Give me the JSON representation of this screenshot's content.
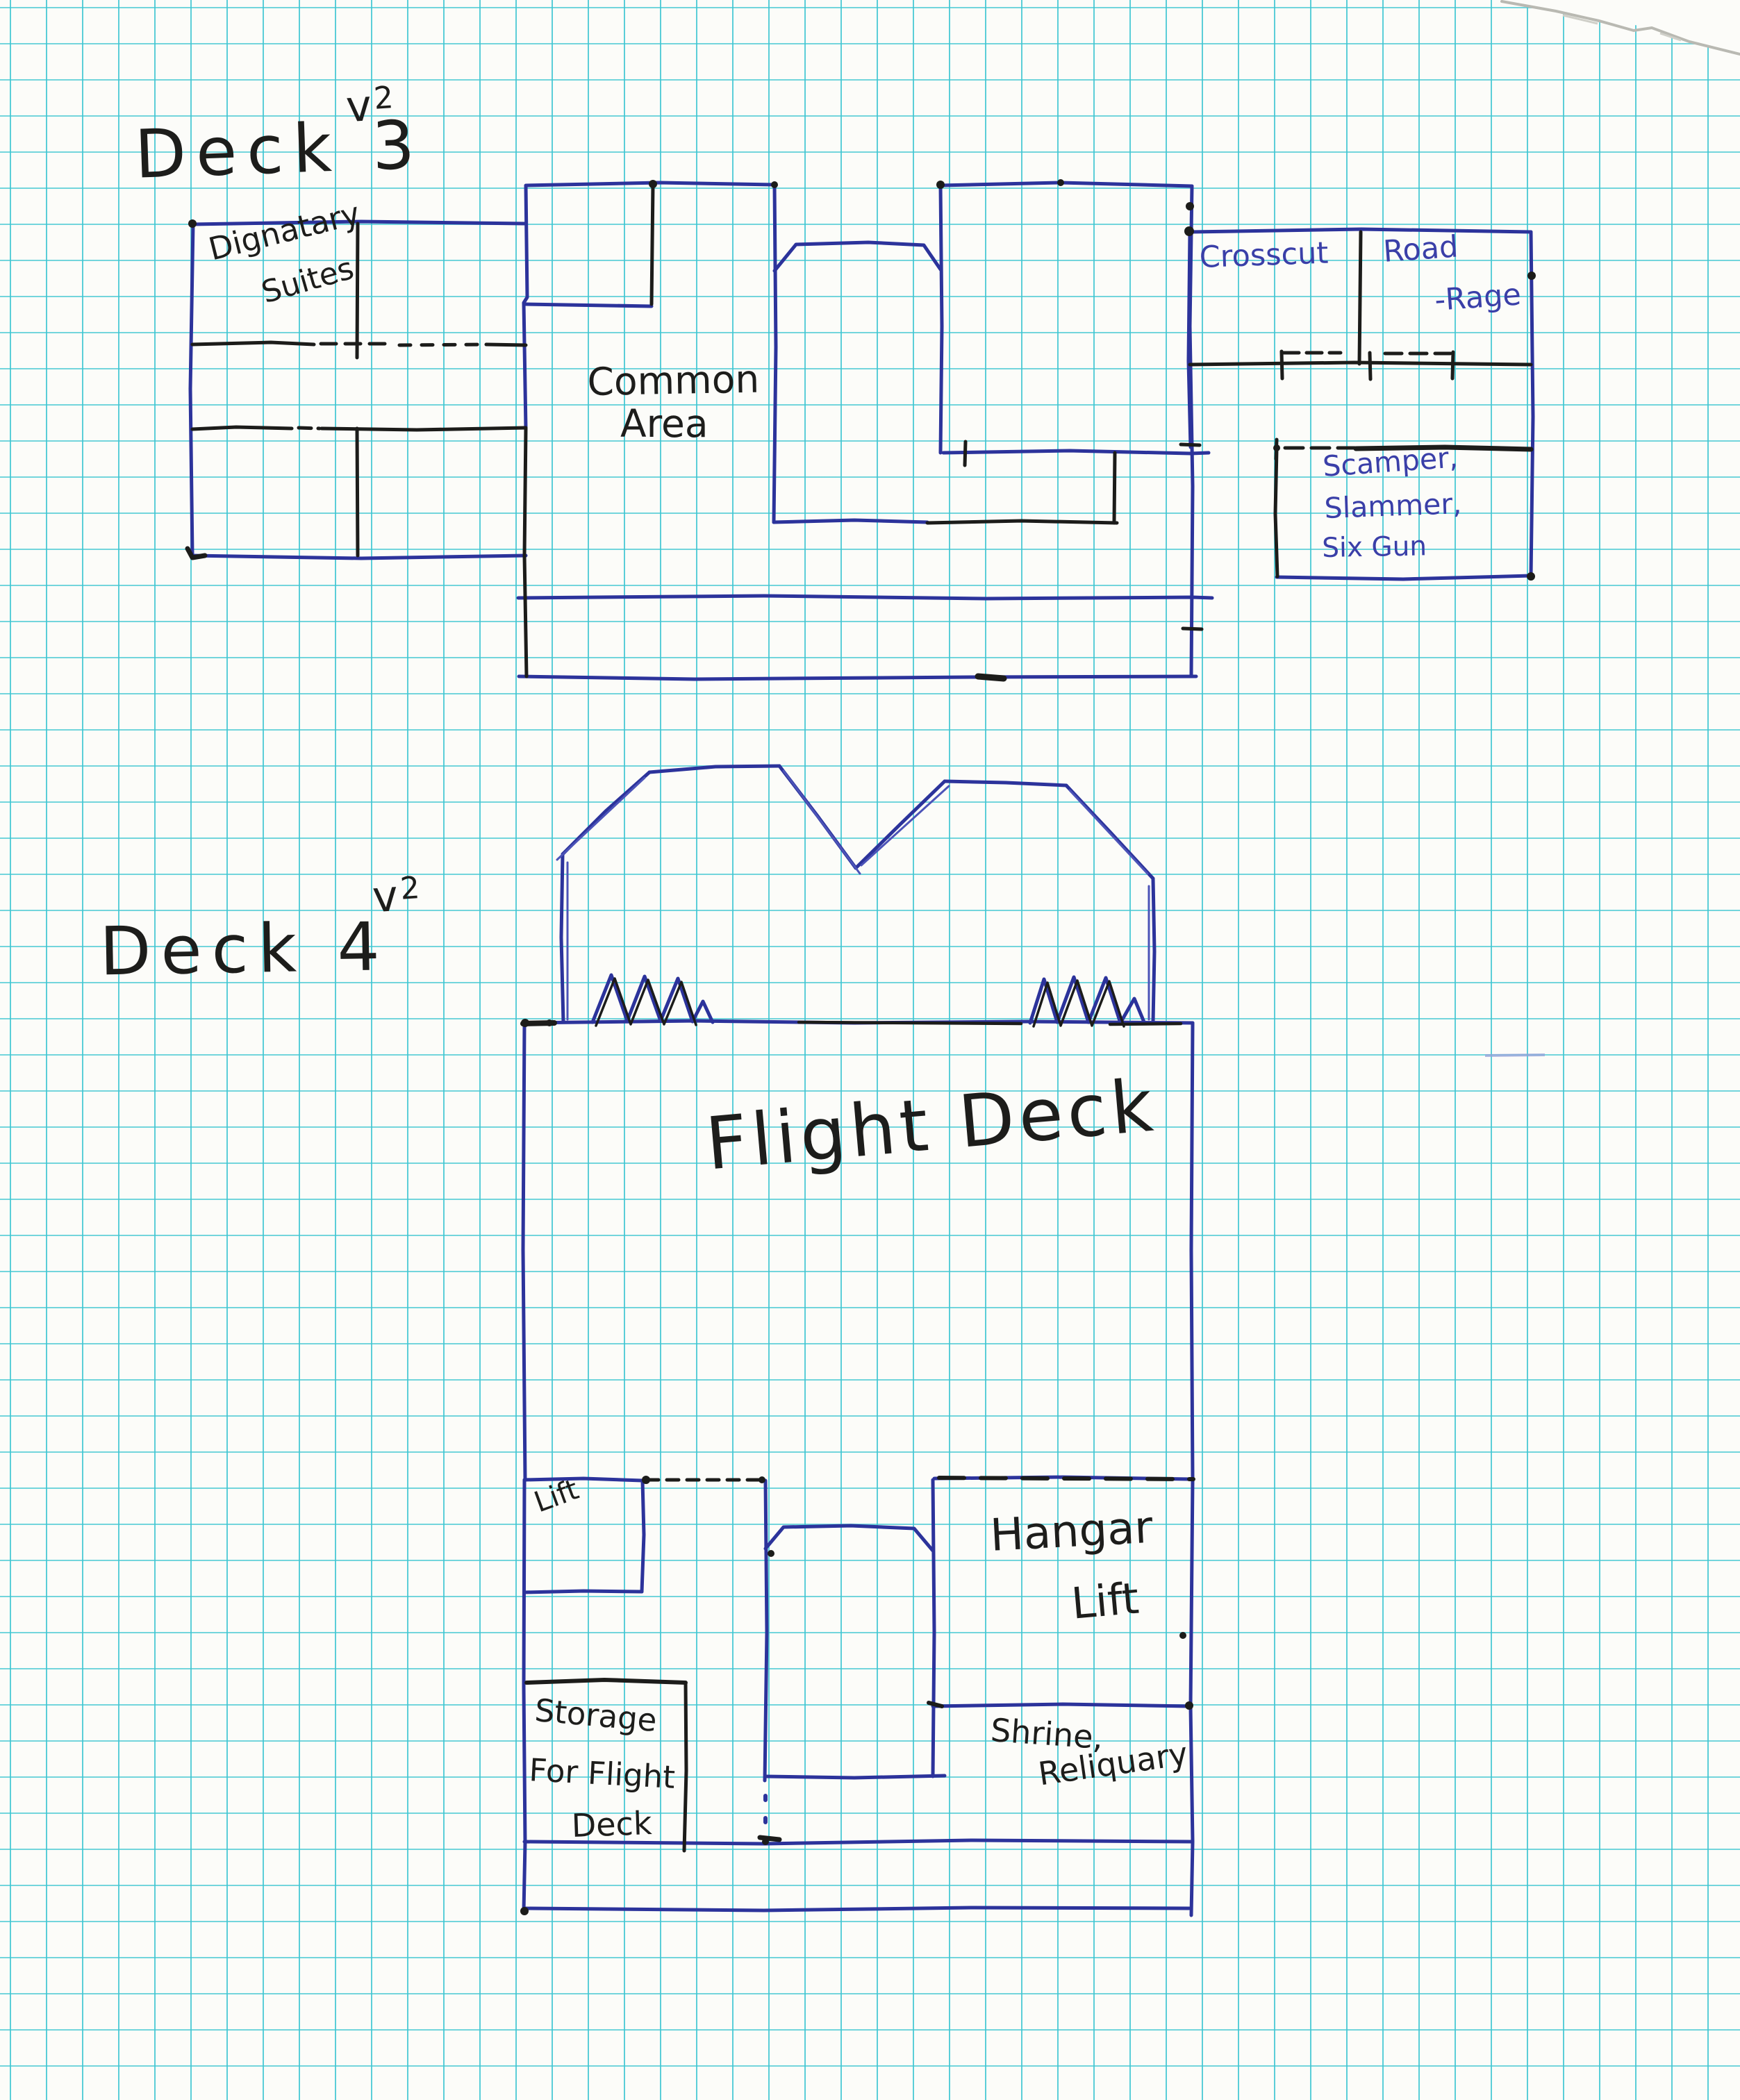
{
  "colors": {
    "paper": "#fcfcf9",
    "grid_cyan": "#3ec6d2",
    "blue_ink": "#2c339b",
    "black_ink": "#1c1c1a",
    "blue_label_ink": "#3a3fa8"
  },
  "deck3": {
    "title": "Deck 3",
    "version_base": "v",
    "version_exponent": "2",
    "rooms": {
      "dignatary_suites_lines": [
        "Dignatary",
        "Suites"
      ],
      "common_area_lines": [
        "Common",
        "Area"
      ],
      "crosscut": "Crosscut",
      "road_rage_lines": [
        "Road",
        "-Rage"
      ],
      "scamper_slammer_six_gun_lines": [
        "Scamper,",
        "Slammer,",
        "Six Gun"
      ]
    }
  },
  "deck4": {
    "title": "Deck 4",
    "version_base": "v",
    "version_exponent": "2",
    "rooms": {
      "flight_deck": "Flight Deck",
      "lift": "Lift",
      "hangar_lift_lines": [
        "Hangar",
        "Lift"
      ],
      "storage_for_flight_deck_lines": [
        "Storage",
        "For Flight",
        "Deck"
      ],
      "shrine_reliquary_lines": [
        "Shrine,",
        "Reliquary"
      ]
    }
  }
}
